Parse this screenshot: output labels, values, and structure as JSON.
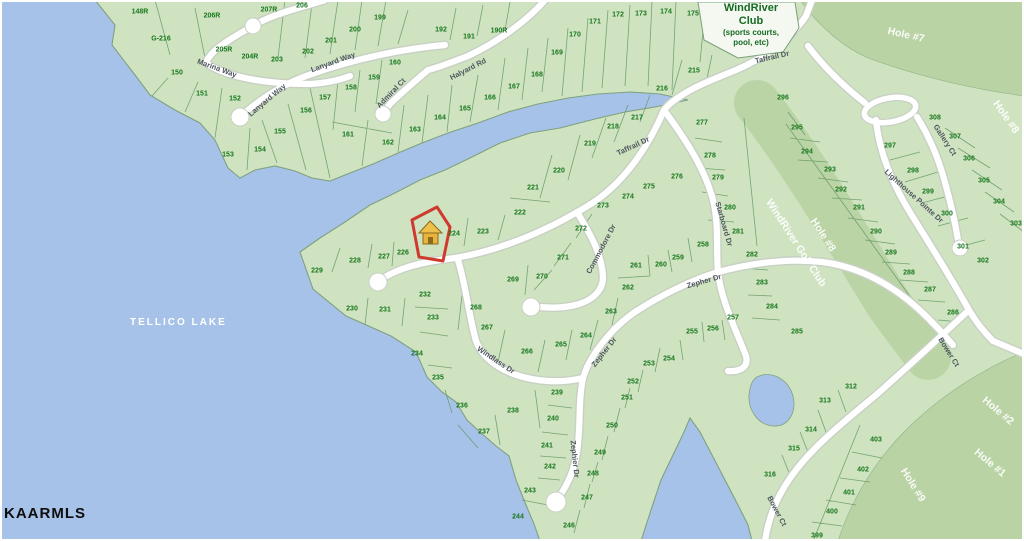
{
  "map": {
    "lake_label": "TELLICO LAKE",
    "watermark": "KAARMLS",
    "club_sign": {
      "line1": "WindRiver",
      "line2": "Club",
      "line3": "(sports courts,",
      "line4": "pool, etc)"
    },
    "selected_parcel": {
      "icon": "house-icon",
      "adjacent_lot": "224"
    },
    "colors": {
      "water": "#a7c2e8",
      "land": "#cfe3c1",
      "golf": "#b9d3a4",
      "road": "#ffffff",
      "parcel_line": "#5d9360",
      "lot_text": "#17771c",
      "street_text": "#4e565e",
      "highlight": "#cf3a2e",
      "house": "#e9b33c"
    },
    "streets": [
      {
        "label": "Marina Way",
        "x": 217,
        "y": 68,
        "rot": 20
      },
      {
        "label": "Lanyard Way",
        "x": 267,
        "y": 100,
        "rot": -40
      },
      {
        "label": "Lanyard Way",
        "x": 333,
        "y": 62,
        "rot": -20
      },
      {
        "label": "Admiral Ct",
        "x": 391,
        "y": 93,
        "rot": -46
      },
      {
        "label": "Halyard Rd",
        "x": 468,
        "y": 69,
        "rot": -27
      },
      {
        "label": "Taffrail Dr",
        "x": 772,
        "y": 57,
        "rot": -13
      },
      {
        "label": "Taffrail Dr",
        "x": 633,
        "y": 146,
        "rot": -25
      },
      {
        "label": "Commodore Dr",
        "x": 601,
        "y": 249,
        "rot": -62
      },
      {
        "label": "Starboard Dr",
        "x": 724,
        "y": 224,
        "rot": 74
      },
      {
        "label": "Zepher Dr",
        "x": 704,
        "y": 281,
        "rot": -16
      },
      {
        "label": "Zepher Dr",
        "x": 604,
        "y": 352,
        "rot": -52
      },
      {
        "label": "Zephier Dr",
        "x": 575,
        "y": 459,
        "rot": 84
      },
      {
        "label": "Windlass Dr",
        "x": 496,
        "y": 360,
        "rot": 34
      },
      {
        "label": "Gallery Ct",
        "x": 945,
        "y": 140,
        "rot": 57
      },
      {
        "label": "Lighthouse Pointe Dr",
        "x": 914,
        "y": 196,
        "rot": 42
      },
      {
        "label": "Bower Ct",
        "x": 949,
        "y": 352,
        "rot": 58
      },
      {
        "label": "Bower Ct",
        "x": 777,
        "y": 511,
        "rot": 62
      }
    ],
    "golf_labels": [
      {
        "label": "Hole #7",
        "x": 906,
        "y": 35,
        "rot": 13
      },
      {
        "label": "Hole #8",
        "x": 1006,
        "y": 117,
        "rot": 55
      },
      {
        "label": "WindRiver Golf Club",
        "x": 796,
        "y": 243,
        "rot": 57
      },
      {
        "label": "Hole #8",
        "x": 823,
        "y": 235,
        "rot": 57
      },
      {
        "label": "Hole #9",
        "x": 913,
        "y": 485,
        "rot": 58
      },
      {
        "label": "Hole #1",
        "x": 990,
        "y": 463,
        "rot": 40
      },
      {
        "label": "Hole #2",
        "x": 998,
        "y": 411,
        "rot": 40
      }
    ],
    "lots": [
      {
        "n": "148R",
        "x": 140,
        "y": 12
      },
      {
        "n": "G-216",
        "x": 161,
        "y": 39
      },
      {
        "n": "206R",
        "x": 212,
        "y": 16
      },
      {
        "n": "207R",
        "x": 269,
        "y": 10
      },
      {
        "n": "206",
        "x": 302,
        "y": 6
      },
      {
        "n": "205R",
        "x": 224,
        "y": 50
      },
      {
        "n": "204R",
        "x": 250,
        "y": 57
      },
      {
        "n": "203",
        "x": 277,
        "y": 60
      },
      {
        "n": "202",
        "x": 308,
        "y": 52
      },
      {
        "n": "201",
        "x": 331,
        "y": 41
      },
      {
        "n": "200",
        "x": 355,
        "y": 30
      },
      {
        "n": "199",
        "x": 380,
        "y": 18
      },
      {
        "n": "150",
        "x": 177,
        "y": 73
      },
      {
        "n": "151",
        "x": 202,
        "y": 94
      },
      {
        "n": "152",
        "x": 235,
        "y": 99
      },
      {
        "n": "153",
        "x": 228,
        "y": 155
      },
      {
        "n": "154",
        "x": 260,
        "y": 150
      },
      {
        "n": "155",
        "x": 280,
        "y": 132
      },
      {
        "n": "156",
        "x": 306,
        "y": 111
      },
      {
        "n": "157",
        "x": 325,
        "y": 98
      },
      {
        "n": "158",
        "x": 351,
        "y": 88
      },
      {
        "n": "159",
        "x": 374,
        "y": 78
      },
      {
        "n": "160",
        "x": 395,
        "y": 63
      },
      {
        "n": "161",
        "x": 348,
        "y": 135
      },
      {
        "n": "162",
        "x": 388,
        "y": 143
      },
      {
        "n": "163",
        "x": 415,
        "y": 130
      },
      {
        "n": "164",
        "x": 440,
        "y": 118
      },
      {
        "n": "165",
        "x": 465,
        "y": 109
      },
      {
        "n": "166",
        "x": 490,
        "y": 98
      },
      {
        "n": "167",
        "x": 514,
        "y": 87
      },
      {
        "n": "168",
        "x": 537,
        "y": 75
      },
      {
        "n": "169",
        "x": 557,
        "y": 53
      },
      {
        "n": "170",
        "x": 575,
        "y": 35
      },
      {
        "n": "171",
        "x": 595,
        "y": 22
      },
      {
        "n": "172",
        "x": 618,
        "y": 15
      },
      {
        "n": "173",
        "x": 641,
        "y": 14
      },
      {
        "n": "174",
        "x": 666,
        "y": 12
      },
      {
        "n": "175",
        "x": 693,
        "y": 14
      },
      {
        "n": "192",
        "x": 441,
        "y": 30
      },
      {
        "n": "191",
        "x": 469,
        "y": 37
      },
      {
        "n": "190R",
        "x": 499,
        "y": 31
      },
      {
        "n": "215",
        "x": 694,
        "y": 71
      },
      {
        "n": "216",
        "x": 662,
        "y": 89
      },
      {
        "n": "217",
        "x": 637,
        "y": 118
      },
      {
        "n": "218",
        "x": 613,
        "y": 127
      },
      {
        "n": "219",
        "x": 590,
        "y": 144
      },
      {
        "n": "220",
        "x": 559,
        "y": 171
      },
      {
        "n": "221",
        "x": 533,
        "y": 188
      },
      {
        "n": "222",
        "x": 520,
        "y": 213
      },
      {
        "n": "223",
        "x": 483,
        "y": 232
      },
      {
        "n": "224",
        "x": 454,
        "y": 234
      },
      {
        "n": "226",
        "x": 403,
        "y": 253
      },
      {
        "n": "227",
        "x": 384,
        "y": 257
      },
      {
        "n": "228",
        "x": 355,
        "y": 261
      },
      {
        "n": "229",
        "x": 317,
        "y": 271
      },
      {
        "n": "230",
        "x": 352,
        "y": 309
      },
      {
        "n": "231",
        "x": 385,
        "y": 310
      },
      {
        "n": "232",
        "x": 425,
        "y": 295
      },
      {
        "n": "233",
        "x": 433,
        "y": 318
      },
      {
        "n": "234",
        "x": 417,
        "y": 354
      },
      {
        "n": "235",
        "x": 438,
        "y": 378
      },
      {
        "n": "236",
        "x": 462,
        "y": 406
      },
      {
        "n": "237",
        "x": 484,
        "y": 432
      },
      {
        "n": "238",
        "x": 513,
        "y": 411
      },
      {
        "n": "239",
        "x": 557,
        "y": 393
      },
      {
        "n": "240",
        "x": 553,
        "y": 419
      },
      {
        "n": "241",
        "x": 547,
        "y": 446
      },
      {
        "n": "242",
        "x": 550,
        "y": 467
      },
      {
        "n": "243",
        "x": 530,
        "y": 491
      },
      {
        "n": "244",
        "x": 518,
        "y": 517
      },
      {
        "n": "246",
        "x": 569,
        "y": 526
      },
      {
        "n": "247",
        "x": 587,
        "y": 498
      },
      {
        "n": "248",
        "x": 593,
        "y": 474
      },
      {
        "n": "249",
        "x": 600,
        "y": 453
      },
      {
        "n": "250",
        "x": 612,
        "y": 426
      },
      {
        "n": "251",
        "x": 627,
        "y": 398
      },
      {
        "n": "252",
        "x": 633,
        "y": 382
      },
      {
        "n": "253",
        "x": 649,
        "y": 364
      },
      {
        "n": "254",
        "x": 669,
        "y": 359
      },
      {
        "n": "255",
        "x": 692,
        "y": 332
      },
      {
        "n": "256",
        "x": 713,
        "y": 329
      },
      {
        "n": "257",
        "x": 733,
        "y": 318
      },
      {
        "n": "258",
        "x": 703,
        "y": 245
      },
      {
        "n": "259",
        "x": 678,
        "y": 258
      },
      {
        "n": "260",
        "x": 661,
        "y": 265
      },
      {
        "n": "261",
        "x": 636,
        "y": 266
      },
      {
        "n": "262",
        "x": 628,
        "y": 288
      },
      {
        "n": "263",
        "x": 611,
        "y": 312
      },
      {
        "n": "264",
        "x": 586,
        "y": 336
      },
      {
        "n": "265",
        "x": 561,
        "y": 345
      },
      {
        "n": "266",
        "x": 527,
        "y": 352
      },
      {
        "n": "267",
        "x": 487,
        "y": 328
      },
      {
        "n": "268",
        "x": 476,
        "y": 308
      },
      {
        "n": "269",
        "x": 513,
        "y": 280
      },
      {
        "n": "270",
        "x": 542,
        "y": 277
      },
      {
        "n": "271",
        "x": 563,
        "y": 258
      },
      {
        "n": "272",
        "x": 581,
        "y": 229
      },
      {
        "n": "273",
        "x": 603,
        "y": 206
      },
      {
        "n": "274",
        "x": 628,
        "y": 197
      },
      {
        "n": "275",
        "x": 649,
        "y": 187
      },
      {
        "n": "276",
        "x": 677,
        "y": 177
      },
      {
        "n": "277",
        "x": 702,
        "y": 123
      },
      {
        "n": "278",
        "x": 710,
        "y": 156
      },
      {
        "n": "279",
        "x": 718,
        "y": 178
      },
      {
        "n": "280",
        "x": 730,
        "y": 208
      },
      {
        "n": "281",
        "x": 738,
        "y": 232
      },
      {
        "n": "282",
        "x": 752,
        "y": 255
      },
      {
        "n": "283",
        "x": 762,
        "y": 283
      },
      {
        "n": "284",
        "x": 772,
        "y": 307
      },
      {
        "n": "285",
        "x": 797,
        "y": 332
      },
      {
        "n": "286",
        "x": 953,
        "y": 313
      },
      {
        "n": "287",
        "x": 930,
        "y": 290
      },
      {
        "n": "288",
        "x": 909,
        "y": 273
      },
      {
        "n": "289",
        "x": 891,
        "y": 253
      },
      {
        "n": "290",
        "x": 876,
        "y": 232
      },
      {
        "n": "291",
        "x": 859,
        "y": 208
      },
      {
        "n": "292",
        "x": 841,
        "y": 190
      },
      {
        "n": "293",
        "x": 830,
        "y": 170
      },
      {
        "n": "294",
        "x": 807,
        "y": 152
      },
      {
        "n": "295",
        "x": 797,
        "y": 128
      },
      {
        "n": "296",
        "x": 783,
        "y": 98
      },
      {
        "n": "297",
        "x": 890,
        "y": 146
      },
      {
        "n": "298",
        "x": 913,
        "y": 171
      },
      {
        "n": "299",
        "x": 928,
        "y": 192
      },
      {
        "n": "300",
        "x": 947,
        "y": 214
      },
      {
        "n": "301",
        "x": 963,
        "y": 247
      },
      {
        "n": "302",
        "x": 983,
        "y": 261
      },
      {
        "n": "303",
        "x": 1016,
        "y": 224
      },
      {
        "n": "304",
        "x": 999,
        "y": 202
      },
      {
        "n": "305",
        "x": 984,
        "y": 181
      },
      {
        "n": "306",
        "x": 969,
        "y": 159
      },
      {
        "n": "307",
        "x": 955,
        "y": 137
      },
      {
        "n": "308",
        "x": 935,
        "y": 118
      },
      {
        "n": "312",
        "x": 851,
        "y": 387
      },
      {
        "n": "313",
        "x": 825,
        "y": 401
      },
      {
        "n": "314",
        "x": 811,
        "y": 430
      },
      {
        "n": "315",
        "x": 794,
        "y": 449
      },
      {
        "n": "316",
        "x": 770,
        "y": 475
      },
      {
        "n": "399",
        "x": 817,
        "y": 536
      },
      {
        "n": "400",
        "x": 832,
        "y": 512
      },
      {
        "n": "401",
        "x": 849,
        "y": 493
      },
      {
        "n": "402",
        "x": 863,
        "y": 470
      },
      {
        "n": "403",
        "x": 876,
        "y": 440
      }
    ]
  }
}
